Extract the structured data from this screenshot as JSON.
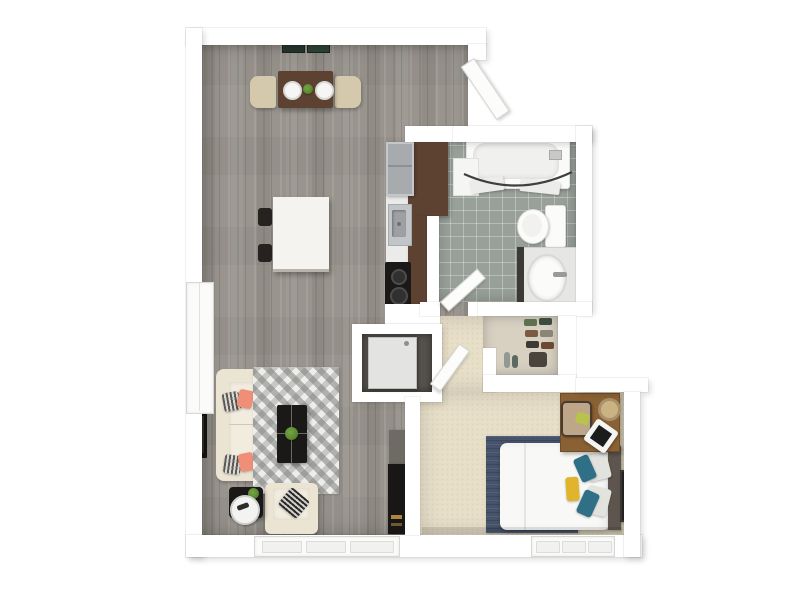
{
  "meta": {
    "type": "3d-floor-plan-rendering",
    "view": "top-down",
    "unit": "one-bedroom-one-bath-apartment",
    "visible_text": ""
  },
  "palette": {
    "wall": "#ffffff",
    "door_white": "#fcfcfb",
    "wood_floor": "#99948d",
    "carpet": "#e8dfc9",
    "tile": "#99a09a",
    "counter_wood": "#5d4232",
    "sofa_cream": "#ece4d3",
    "accent_coral": "#ef8f77",
    "accent_teal": "#2f7086",
    "accent_yellow": "#e0b42c",
    "rug_navy": "#46536a",
    "appliance_dark": "#1a1918",
    "plant_green": "#5a8a2f",
    "desk_wood": "#8a6134",
    "bed_white": "#f8f8f6",
    "headboard": "#5d554e"
  },
  "rooms": [
    {
      "name": "living-dining",
      "floor": "gray wood plank",
      "furniture": [
        "dining-table",
        "dining-chair-left",
        "dining-chair-right",
        "place-settings",
        "centerpiece-plant",
        "kitchen-island",
        "island-stools",
        "sofa",
        "chevron-rug",
        "coffee-table",
        "coffee-table-plant",
        "armchair",
        "side-table",
        "serving-tray",
        "wall-tv",
        "media-cabinet",
        "ceiling-vents"
      ]
    },
    {
      "name": "kitchen",
      "floor": "gray wood plank",
      "furniture": [
        "refrigerator",
        "counter-run",
        "sink",
        "cooktop"
      ]
    },
    {
      "name": "bathroom",
      "floor": "gray tile",
      "furniture": [
        "bathtub",
        "curved-shower-rod",
        "toilet",
        "vanity-sink"
      ]
    },
    {
      "name": "laundry-closet",
      "furniture": [
        "stacked-washer"
      ]
    },
    {
      "name": "hallway",
      "floor": "beige carpet",
      "furniture": []
    },
    {
      "name": "walk-in-closet",
      "furniture": [
        "shoe-shelves",
        "bottles",
        "storage-pile"
      ]
    },
    {
      "name": "bedroom",
      "floor": "beige carpet",
      "furniture": [
        "bed",
        "headboard",
        "navy-rug",
        "teal-pillows",
        "gray-pillows",
        "yellow-pillow",
        "desk",
        "desk-chair",
        "laptop",
        "notepad",
        "basket",
        "wall-art"
      ]
    }
  ],
  "windows": [
    {
      "location": "left-wall-living"
    },
    {
      "location": "bottom-wall-living",
      "panes": 3
    },
    {
      "location": "bottom-wall-bedroom",
      "panes": 3
    }
  ],
  "doors": [
    {
      "location": "entry-top-right",
      "state": "open"
    },
    {
      "location": "bathroom",
      "state": "open"
    },
    {
      "location": "bedroom",
      "state": "open"
    }
  ]
}
